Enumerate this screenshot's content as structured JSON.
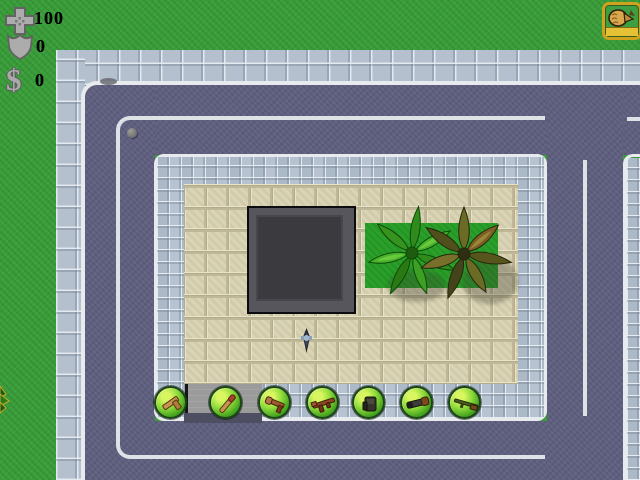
{
  "hud": {
    "health": {
      "icon": "health-cross-icon",
      "value": "100"
    },
    "armor": {
      "icon": "armor-shield-icon",
      "value": "0"
    },
    "money": {
      "icon": "dollar-icon",
      "symbol": "$",
      "value": "0"
    }
  },
  "weapon_slot": {
    "icon": "fist-icon",
    "name": "fist",
    "ammo_bar": "full"
  },
  "pickups": [
    {
      "name": "pistol"
    },
    {
      "name": "club"
    },
    {
      "name": "shotgun"
    },
    {
      "name": "machine-gun"
    },
    {
      "name": "flamethrower"
    },
    {
      "name": "rocket-launcher"
    },
    {
      "name": "rifle"
    }
  ],
  "scene": {
    "player": "player-character",
    "building": "building-roof",
    "trees": [
      "palm-tree-green",
      "palm-tree-olive"
    ],
    "props": [
      "pebble",
      "road-smudge",
      "edge-plant",
      "entrance-pad"
    ],
    "colors": {
      "grass": "#3a9c3a",
      "road": "#5e5e7e",
      "sidewalk": "#b4c0ce",
      "plaza_tile": "#d8d2b2",
      "curb": "#e8ebee",
      "grass_patch": "#2aa02a",
      "pickup_ring": "#1c4418",
      "pickup_fill": "#7ed23a",
      "slot_border": "#cfa21e",
      "slot_ammo_bar": "#e6c135",
      "hud_icon_gray": "#a9a9a9",
      "hud_text": "#000000"
    }
  }
}
